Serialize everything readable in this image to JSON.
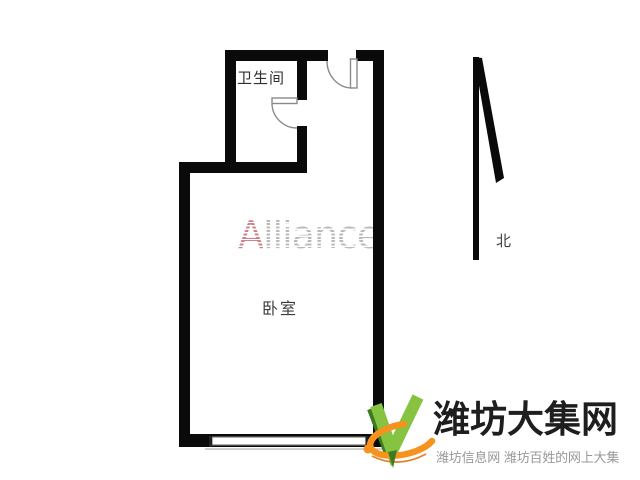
{
  "floor_plan": {
    "bathroom_label": "卫生间",
    "bedroom_label": "卧室",
    "north_label": "北",
    "wall_color": "#0a0a0a"
  },
  "watermark": {
    "lead": "A",
    "rest": "lliance",
    "lead_color": "#d38d93",
    "rest_color": "#c2c2c2"
  },
  "logo": {
    "title": "潍坊大集网",
    "subtitle": "潍坊信息网 潍坊百姓的网上大集",
    "title_color": "#1e1e1e",
    "subtitle_color": "#989898",
    "checkmark_color": "#85C341",
    "checkmark_shadow_color": "#3E7A22",
    "swoosh_color": "#F6921E"
  }
}
